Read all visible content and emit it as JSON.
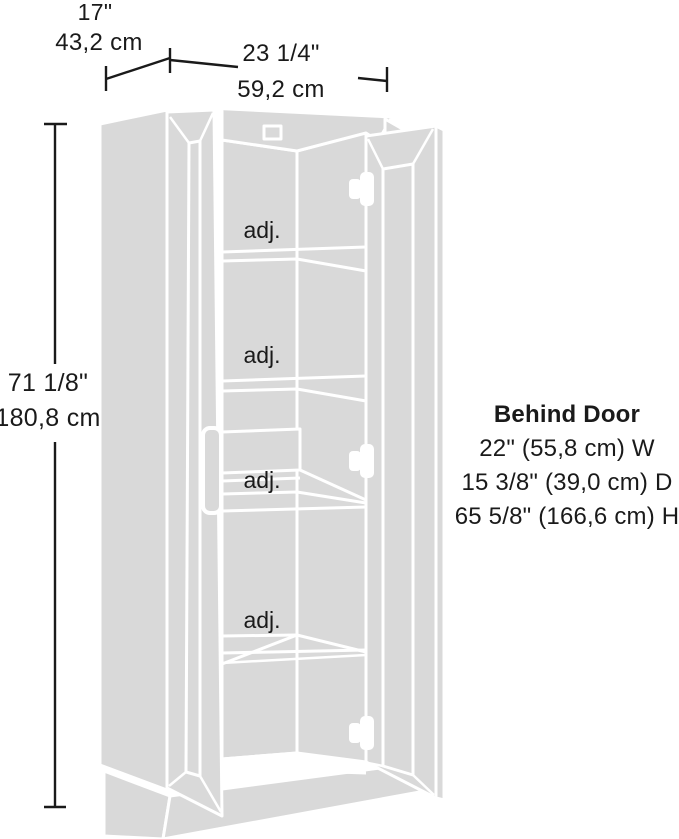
{
  "diagram": {
    "type": "product-dimension-drawing",
    "subject": "storage-cabinet-with-open-doors",
    "overall_dimensions": {
      "depth_in": "17\"",
      "depth_cm": "43,2 cm",
      "width_in": "23 1/4\"",
      "width_cm": "59,2 cm",
      "height_in": "71 1/8\"",
      "height_cm": "180,8 cm"
    },
    "behind_door": {
      "title": "Behind Door",
      "width_line": "22\" (55,8 cm) W",
      "depth_line": "15 3/8\" (39,0 cm) D",
      "height_line": "65 5/8\" (166,6 cm) H"
    },
    "shelf_labels": [
      "adj.",
      "adj.",
      "adj.",
      "adj."
    ],
    "colors": {
      "background": "#ffffff",
      "artwork_fill": "#d9d9d9",
      "artwork_line": "#ffffff",
      "annotation": "#1a1a1a"
    }
  }
}
